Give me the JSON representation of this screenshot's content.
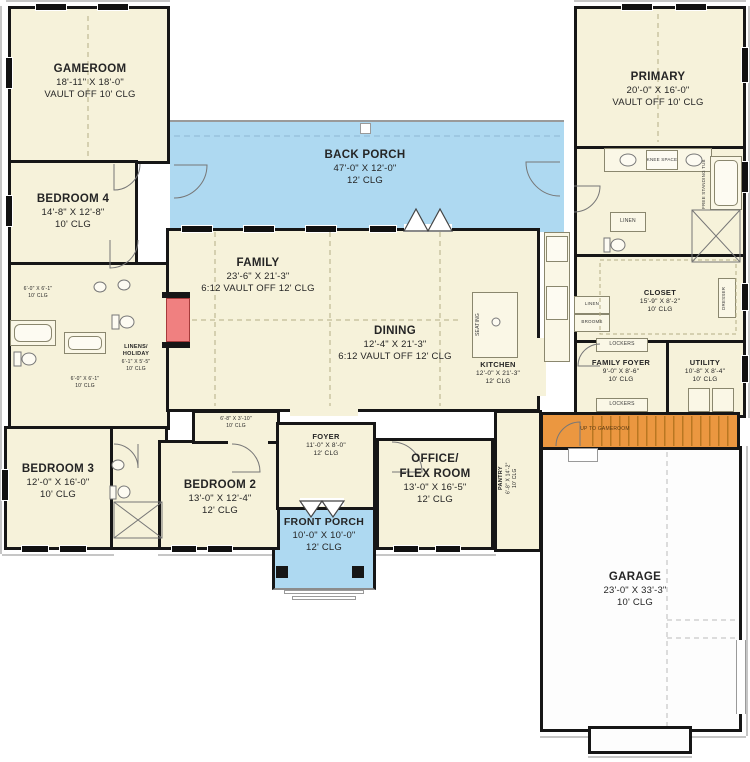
{
  "plan": {
    "rooms": {
      "gameroom": {
        "name": "GAMEROOM",
        "dims": "18'-11\" X 18'-0\"",
        "clg": "VAULT OFF 10' CLG"
      },
      "bedroom4": {
        "name": "BEDROOM 4",
        "dims": "14'-8\" X 12'-8\"",
        "clg": "10' CLG"
      },
      "bedroom3": {
        "name": "BEDROOM 3",
        "dims": "12'-0\" X 16'-0\"",
        "clg": "10' CLG"
      },
      "bedroom2": {
        "name": "BEDROOM 2",
        "dims": "13'-0\" X 12'-4\"",
        "clg": "12' CLG"
      },
      "family": {
        "name": "FAMILY",
        "dims": "23'-6\" X 21'-3\"",
        "clg": "6:12 VAULT OFF 12' CLG"
      },
      "dining": {
        "name": "DINING",
        "dims": "12'-4\" X 21'-3\"",
        "clg": "6:12 VAULT OFF 12' CLG"
      },
      "kitchen": {
        "name": "KITCHEN",
        "dims": "12'-0\" X 21'-3\"",
        "clg": "12' CLG"
      },
      "pantry": {
        "name": "PANTRY",
        "dims": "6'-8\" X 14'-2\"",
        "clg": "10' CLG"
      },
      "back_porch": {
        "name": "BACK PORCH",
        "dims": "47'-0\" X 12'-0\"",
        "clg": "12' CLG"
      },
      "front_porch": {
        "name": "FRONT PORCH",
        "dims": "10'-0\" X 10'-0\"",
        "clg": "12' CLG"
      },
      "foyer": {
        "name": "FOYER",
        "dims": "11'-0\" X 8'-0\"",
        "clg": "12' CLG"
      },
      "office": {
        "name1": "OFFICE/",
        "name2": "FLEX ROOM",
        "dims": "13'-0\" X 16'-5\"",
        "clg": "12' CLG"
      },
      "primary": {
        "name": "PRIMARY",
        "dims": "20'-0\" X 16'-0\"",
        "clg": "VAULT OFF 10' CLG"
      },
      "closet": {
        "name": "CLOSET",
        "dims": "15'-9\" X 8'-2\"",
        "clg": "10' CLG"
      },
      "family_foyer": {
        "name": "FAMILY FOYER",
        "dims": "9'-0\" X 8'-6\"",
        "clg": "10' CLG"
      },
      "utility": {
        "name": "UTILITY",
        "dims": "10'-8\" X 8'-4\"",
        "clg": "10' CLG"
      },
      "garage": {
        "name": "GARAGE",
        "dims": "23'-0\" X 33'-3\"",
        "clg": "10' CLG"
      },
      "bath_a": {
        "dims": "6'-0\" X 6'-1\"",
        "clg": "10' CLG"
      },
      "bath_b": {
        "dims": "6'-0\" X 6'-1\"",
        "clg": "10' CLG"
      },
      "linens": {
        "name1": "LINENS/",
        "name2": "HOLIDAY",
        "dims": "6'-1\" X 5'-5\"",
        "clg": "10' CLG"
      },
      "bed2_closet": {
        "dims": "6'-8\" X 3'-10\"",
        "clg": "10' CLG"
      }
    },
    "annotations": {
      "stairs": "UP TO GAMEROOM",
      "seating": "SEATING",
      "knee_space": "KNEE SPACE",
      "tub": "FREE STANDING TUB",
      "linen_bath": "LINEN",
      "linen_hall": "LINEN",
      "brooms": "BROOMS",
      "lockers_a": "LOCKERS",
      "lockers_b": "LOCKERS",
      "dresser": "DRESSER"
    },
    "colors": {
      "room_fill": "#f6f2da",
      "porch_blue": "#aed9f1",
      "stairs_orange": "#eb9740",
      "fireplace_red": "#f08080",
      "wall": "#161616"
    }
  }
}
